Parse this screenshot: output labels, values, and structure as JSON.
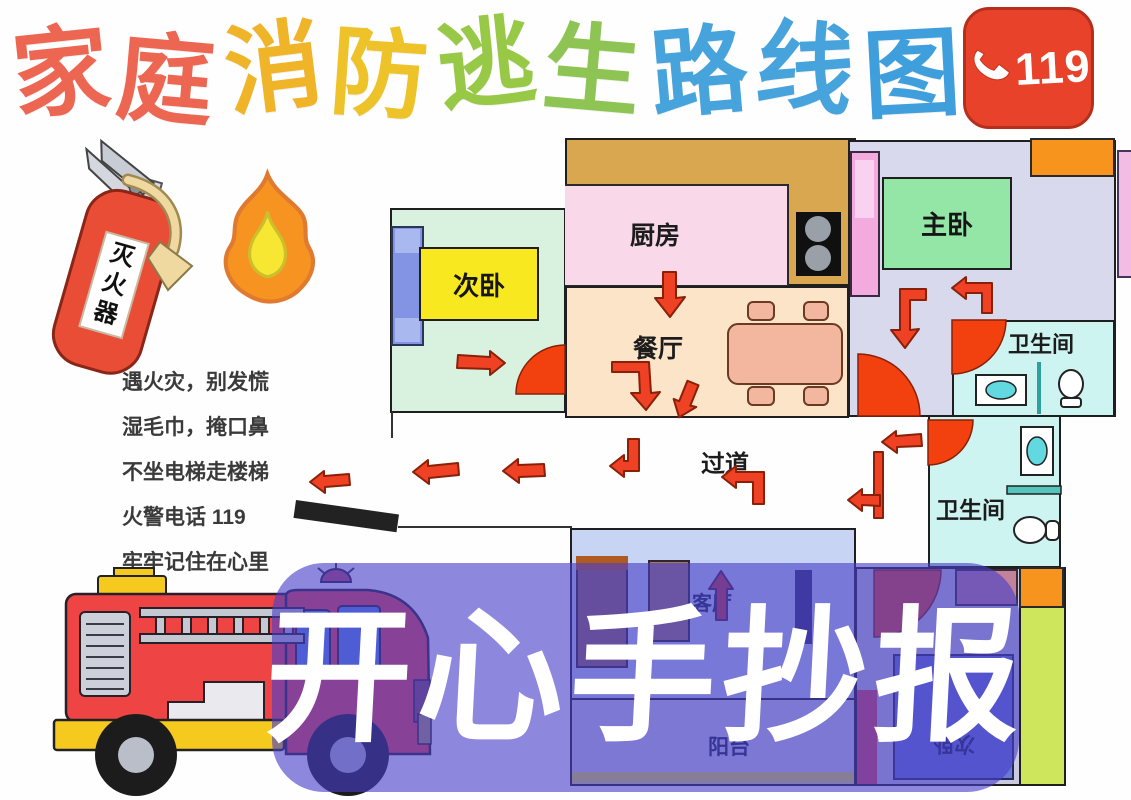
{
  "title": {
    "text": "家庭消防逃生路线图",
    "chars": [
      {
        "ch": "家",
        "color": "#ec6652"
      },
      {
        "ch": "庭",
        "color": "#ec6652"
      },
      {
        "ch": "消",
        "color": "#f0b429"
      },
      {
        "ch": "防",
        "color": "#eec32a"
      },
      {
        "ch": "逃",
        "color": "#97c846"
      },
      {
        "ch": "生",
        "color": "#8ec454"
      },
      {
        "ch": "路",
        "color": "#47a3dc"
      },
      {
        "ch": "线",
        "color": "#47a3dc"
      },
      {
        "ch": "图",
        "color": "#3f9fdd"
      }
    ]
  },
  "badge": {
    "number": "119",
    "icon": "phone-handset",
    "bg_color": "#e8432a"
  },
  "poem": {
    "lines": [
      "遇火灾，别发慌",
      "湿毛巾，掩口鼻",
      "不坐电梯走楼梯",
      "火警电话 119",
      "牢牢记住在心里"
    ]
  },
  "illustrations": {
    "fire_extinguisher_label": "灭火器"
  },
  "floor_plan": {
    "rooms": {
      "bedroom_left": {
        "label": "次卧"
      },
      "kitchen": {
        "label": "厨房"
      },
      "dining": {
        "label": "餐厅"
      },
      "master_bedroom": {
        "label": "主卧"
      },
      "bathroom_top": {
        "label": "卫生间"
      },
      "bathroom_mid": {
        "label": "卫生间"
      },
      "corridor": {
        "label": "过道"
      },
      "living_room": {
        "label": "客厅"
      },
      "balcony": {
        "label": "阳台"
      },
      "bedroom_bottom": {
        "label": "次卧"
      }
    },
    "escape_arrow_color": "#ef4123",
    "door_color": "#f2410f"
  },
  "watermark": {
    "text": "开心手抄报"
  }
}
